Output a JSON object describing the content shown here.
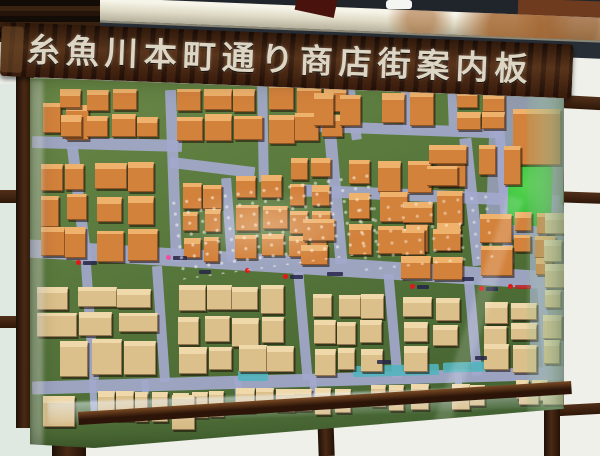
{
  "sign": {
    "title": "糸魚川本町通り商店街案内板"
  },
  "colors": {
    "wood_dark": "#2a150a",
    "plank": "#402412",
    "sign_text": "#ddd6c4",
    "beam": "#e3e1d1",
    "rust": "#a2622b",
    "shadow_band": "#272e36",
    "panel": "#eef0e9",
    "panel_tint": "#dfe8e1",
    "frame": "#3a1d0e",
    "base_green": "#57753b",
    "street": "#a3a8cc",
    "park": "#3cc33f",
    "water": "#52b4bc",
    "marker_red": "#e21818",
    "marker_pink": "#f04fa0",
    "marker_label": "#26264a",
    "building_orange": "#d3823c",
    "building_orange_top": "#eeb26c",
    "building_tan": "#dcc08b",
    "building_tan_top": "#efd9ab"
  },
  "map": {
    "palettes": {
      "a": {
        "body": "#d3823c",
        "top": "#eeb26c"
      },
      "b": {
        "body": "#dcc08b",
        "top": "#efd9ab"
      }
    },
    "plazas": [
      {
        "x": 458,
        "y": 16,
        "w": 76,
        "h": 150,
        "r": 2
      },
      {
        "x": 500,
        "y": 130,
        "w": 34,
        "h": 180,
        "r": 0
      }
    ],
    "streets": [
      {
        "x": 2,
        "y": 64,
        "w": 150,
        "h": 12,
        "r": 1.5
      },
      {
        "x": 140,
        "y": 88,
        "w": 85,
        "h": 11,
        "r": 7
      },
      {
        "x": 272,
        "y": 50,
        "w": 200,
        "h": 11,
        "r": 2
      },
      {
        "x": 272,
        "y": 116,
        "w": 258,
        "h": 12,
        "r": 2.5
      },
      {
        "x": -2,
        "y": 182,
        "w": 542,
        "h": 18,
        "r": 3.5
      },
      {
        "x": 2,
        "y": 300,
        "w": 540,
        "h": 13,
        "r": -1.6
      },
      {
        "x": 44,
        "y": 72,
        "w": 11,
        "h": 118,
        "r": -7
      },
      {
        "x": 138,
        "y": 16,
        "w": 11,
        "h": 172,
        "r": -2
      },
      {
        "x": 194,
        "y": 104,
        "w": 10,
        "h": 84,
        "r": -4
      },
      {
        "x": 228,
        "y": 12,
        "w": 10,
        "h": 96,
        "r": -1
      },
      {
        "x": 300,
        "y": 62,
        "w": 12,
        "h": 128,
        "r": -5
      },
      {
        "x": 318,
        "y": 10,
        "w": 10,
        "h": 56,
        "r": -8
      },
      {
        "x": 372,
        "y": 12,
        "w": 9,
        "h": 44,
        "r": -3
      },
      {
        "x": 436,
        "y": 64,
        "w": 12,
        "h": 128,
        "r": -6
      },
      {
        "x": 418,
        "y": 10,
        "w": 9,
        "h": 42,
        "r": -2
      },
      {
        "x": 468,
        "y": 22,
        "w": 10,
        "h": 168,
        "r": -4
      },
      {
        "x": 55,
        "y": 190,
        "w": 10,
        "h": 116,
        "r": -4
      },
      {
        "x": 126,
        "y": 192,
        "w": 10,
        "h": 116,
        "r": -4
      },
      {
        "x": 268,
        "y": 198,
        "w": 10,
        "h": 108,
        "r": -5
      },
      {
        "x": 358,
        "y": 200,
        "w": 10,
        "h": 104,
        "r": -5
      },
      {
        "x": 438,
        "y": 204,
        "w": 10,
        "h": 98,
        "r": -5
      },
      {
        "x": 510,
        "y": 208,
        "w": 9,
        "h": 88,
        "r": -4
      },
      {
        "x": 60,
        "y": 306,
        "w": 7,
        "h": 36,
        "r": -3
      },
      {
        "x": 112,
        "y": 306,
        "w": 7,
        "h": 34,
        "r": -3
      },
      {
        "x": 205,
        "y": 304,
        "w": 7,
        "h": 33,
        "r": -3
      },
      {
        "x": 280,
        "y": 301,
        "w": 7,
        "h": 32,
        "r": -3
      },
      {
        "x": 425,
        "y": 295,
        "w": 7,
        "h": 30,
        "r": -3
      }
    ],
    "park": {
      "x": 478,
      "y": 88,
      "w": 44,
      "h": 64,
      "r": 2
    },
    "water": [
      {
        "x": 208,
        "y": 296,
        "w": 30,
        "h": 11,
        "r": 0
      },
      {
        "x": 323,
        "y": 291,
        "w": 86,
        "h": 11,
        "r": -1.5
      },
      {
        "x": 413,
        "y": 288,
        "w": 48,
        "h": 10,
        "r": -1.5
      }
    ],
    "clusters": [
      {
        "x": 12,
        "y": 30,
        "w": 44,
        "h": 34,
        "cols": 2,
        "rows": 1,
        "pal": "a"
      },
      {
        "x": 30,
        "y": 16,
        "w": 100,
        "h": 48,
        "cols": 4,
        "rows": 2,
        "pal": "a"
      },
      {
        "x": 146,
        "y": 14,
        "w": 84,
        "h": 52,
        "cols": 3,
        "rows": 2,
        "pal": "a"
      },
      {
        "x": 240,
        "y": 11,
        "w": 76,
        "h": 55,
        "cols": 3,
        "rows": 2,
        "pal": "a"
      },
      {
        "x": 12,
        "y": 90,
        "w": 46,
        "h": 92,
        "cols": 2,
        "rows": 3,
        "pal": "a"
      },
      {
        "x": 66,
        "y": 88,
        "w": 62,
        "h": 98,
        "cols": 2,
        "rows": 3,
        "pal": "a"
      },
      {
        "x": 154,
        "y": 84,
        "w": 38,
        "h": 102,
        "cols": 2,
        "rows": 4,
        "pal": "a"
      },
      {
        "x": 206,
        "y": 102,
        "w": 48,
        "h": 84,
        "cols": 2,
        "rows": 3,
        "pal": "a"
      },
      {
        "x": 260,
        "y": 84,
        "w": 38,
        "h": 100,
        "cols": 2,
        "rows": 4,
        "pal": "a"
      },
      {
        "x": 283,
        "y": 20,
        "w": 52,
        "h": 38,
        "cols": 2,
        "rows": 1,
        "pal": "a"
      },
      {
        "x": 352,
        "y": 18,
        "w": 52,
        "h": 34,
        "cols": 2,
        "rows": 1,
        "pal": "a"
      },
      {
        "x": 320,
        "y": 86,
        "w": 112,
        "h": 94,
        "cols": 4,
        "rows": 3,
        "pal": "a"
      },
      {
        "x": 428,
        "y": 18,
        "w": 46,
        "h": 38,
        "cols": 2,
        "rows": 2,
        "pal": "a"
      },
      {
        "x": 482,
        "y": 34,
        "w": 44,
        "h": 52,
        "cols": 1,
        "rows": 1,
        "pal": "a"
      },
      {
        "x": 398,
        "y": 72,
        "w": 36,
        "h": 40,
        "cols": 1,
        "rows": 2,
        "pal": "a"
      },
      {
        "x": 450,
        "y": 72,
        "w": 42,
        "h": 36,
        "cols": 2,
        "rows": 1,
        "pal": "a"
      },
      {
        "x": 484,
        "y": 138,
        "w": 42,
        "h": 66,
        "cols": 2,
        "rows": 3,
        "pal": "a"
      },
      {
        "x": 450,
        "y": 140,
        "w": 34,
        "h": 60,
        "cols": 1,
        "rows": 2,
        "pal": "a"
      },
      {
        "x": 372,
        "y": 128,
        "w": 58,
        "h": 78,
        "cols": 2,
        "rows": 3,
        "pal": "a"
      },
      {
        "x": 272,
        "y": 146,
        "w": 28,
        "h": 46,
        "cols": 1,
        "rows": 2,
        "pal": "a"
      },
      {
        "x": 8,
        "y": 214,
        "w": 118,
        "h": 48,
        "cols": 3,
        "rows": 2,
        "pal": "b"
      },
      {
        "x": 148,
        "y": 212,
        "w": 108,
        "h": 58,
        "cols": 4,
        "rows": 2,
        "pal": "b"
      },
      {
        "x": 284,
        "y": 220,
        "w": 68,
        "h": 52,
        "cols": 3,
        "rows": 2,
        "pal": "b"
      },
      {
        "x": 374,
        "y": 224,
        "w": 58,
        "h": 48,
        "cols": 2,
        "rows": 2,
        "pal": "b"
      },
      {
        "x": 454,
        "y": 228,
        "w": 52,
        "h": 42,
        "cols": 2,
        "rows": 2,
        "pal": "b"
      },
      {
        "x": 30,
        "y": 266,
        "w": 92,
        "h": 34,
        "cols": 3,
        "rows": 1,
        "pal": "b"
      },
      {
        "x": 150,
        "y": 272,
        "w": 112,
        "h": 28,
        "cols": 4,
        "rows": 1,
        "pal": "b"
      },
      {
        "x": 284,
        "y": 274,
        "w": 68,
        "h": 26,
        "cols": 3,
        "rows": 1,
        "pal": "b"
      },
      {
        "x": 374,
        "y": 272,
        "w": 58,
        "h": 26,
        "cols": 2,
        "rows": 1,
        "pal": "b"
      },
      {
        "x": 454,
        "y": 270,
        "w": 56,
        "h": 26,
        "cols": 2,
        "rows": 1,
        "pal": "b"
      },
      {
        "x": 48,
        "y": 318,
        "w": 148,
        "h": 28,
        "cols": 8,
        "rows": 1,
        "pal": "b"
      },
      {
        "x": 205,
        "y": 314,
        "w": 118,
        "h": 26,
        "cols": 6,
        "rows": 1,
        "pal": "b"
      },
      {
        "x": 340,
        "y": 310,
        "w": 118,
        "h": 24,
        "cols": 6,
        "rows": 1,
        "pal": "b"
      },
      {
        "x": 468,
        "y": 306,
        "w": 50,
        "h": 22,
        "cols": 3,
        "rows": 1,
        "pal": "b"
      },
      {
        "x": 14,
        "y": 322,
        "w": 34,
        "h": 30,
        "cols": 1,
        "rows": 1,
        "pal": "b"
      },
      {
        "x": 142,
        "y": 322,
        "w": 28,
        "h": 36,
        "cols": 1,
        "rows": 1,
        "pal": "b"
      },
      {
        "x": 488,
        "y": 312,
        "w": 44,
        "h": 20,
        "cols": 2,
        "rows": 1,
        "pal": "b"
      },
      {
        "x": 514,
        "y": 140,
        "w": 20,
        "h": 150,
        "cols": 1,
        "rows": 6,
        "pal": "b"
      }
    ],
    "markers": [
      {
        "x": 46,
        "y": 186,
        "dot": "red",
        "lw": 14
      },
      {
        "x": 136,
        "y": 181,
        "dot": "pink",
        "lw": 14
      },
      {
        "x": 162,
        "y": 195,
        "dot": "",
        "lw": 12
      },
      {
        "x": 215,
        "y": 194,
        "dot": "red",
        "lw": 0
      },
      {
        "x": 253,
        "y": 200,
        "dot": "red",
        "lw": 13
      },
      {
        "x": 290,
        "y": 197,
        "dot": "",
        "lw": 16
      },
      {
        "x": 380,
        "y": 210,
        "dot": "red",
        "lw": 12
      },
      {
        "x": 425,
        "y": 202,
        "dot": "",
        "lw": 12
      },
      {
        "x": 449,
        "y": 212,
        "dot": "red",
        "lw": 12
      },
      {
        "x": 478,
        "y": 210,
        "dot": "red",
        "lw": 16,
        "lc": "#c02020"
      },
      {
        "x": 340,
        "y": 285,
        "dot": "",
        "lw": 14
      },
      {
        "x": 438,
        "y": 281,
        "dot": "",
        "lw": 12
      }
    ]
  }
}
